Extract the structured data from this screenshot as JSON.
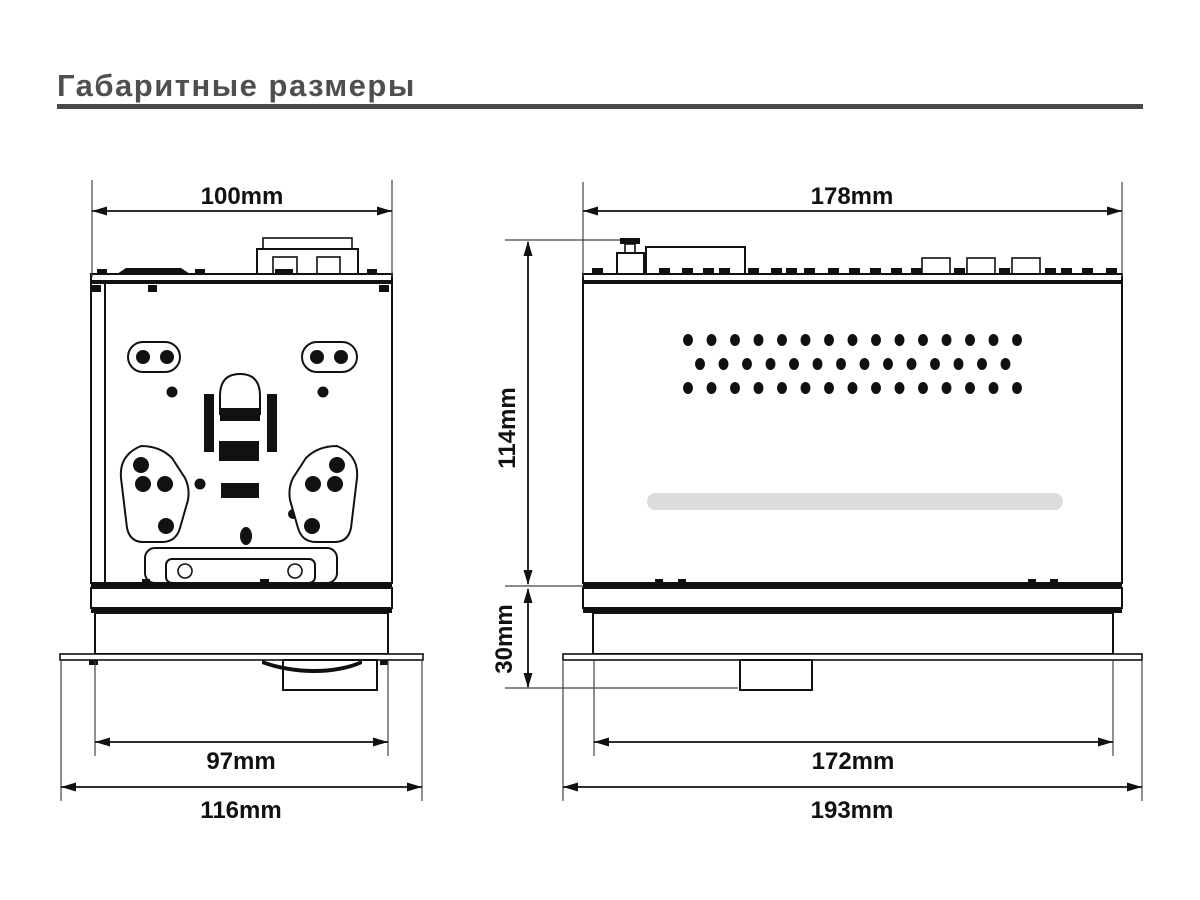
{
  "page": {
    "title": "Габаритные размеры"
  },
  "colors": {
    "background": "#ffffff",
    "title": "#4f4f4f",
    "rule": "#4a4a4a",
    "ink": "#111111",
    "extension": "#444444",
    "slot": "#dcdcdc"
  },
  "views": {
    "top": {
      "dims": {
        "chassis_width": "100mm",
        "sleeve_width": "97mm",
        "trim_width": "116mm"
      }
    },
    "side": {
      "dims": {
        "chassis_width": "178mm",
        "chassis_height": "114mm",
        "nose_height": "30mm",
        "sleeve_width": "172mm",
        "trim_width": "193mm"
      }
    }
  }
}
